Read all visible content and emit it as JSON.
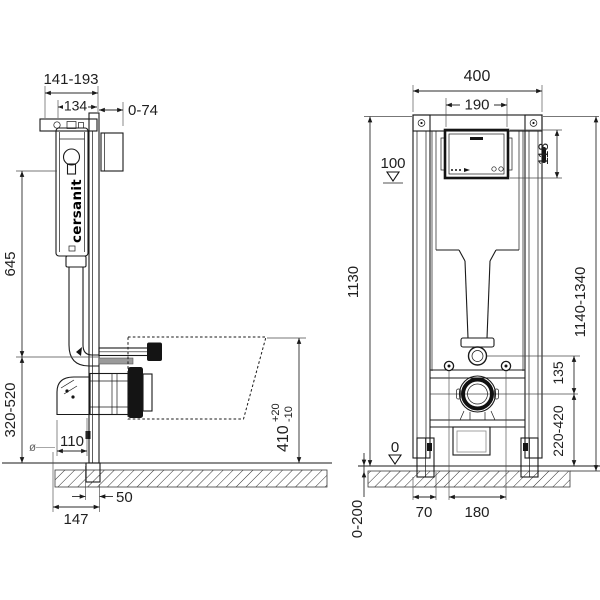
{
  "brand": {
    "logo": "cersanit"
  },
  "side_view": {
    "dims": {
      "depth_range": "141-193",
      "bracket_depth": "134",
      "wall_gap": "0-74",
      "cistern_height": "645",
      "outlet_height_range": "320-520",
      "bowl_height": "410",
      "bowl_height_plus": "+20",
      "bowl_height_minus": "-10",
      "drain_diameter_symbol": "ø",
      "drain_diameter": "110",
      "foot_depth": "50",
      "frame_depth": "147"
    }
  },
  "front_view": {
    "dims": {
      "frame_width": "400",
      "access_panel_width": "190",
      "access_panel_height": "118",
      "level_mark_top": "100",
      "frame_height": "1130",
      "overall_height_range": "1140-1340",
      "flush_outlet_offset": "135",
      "drain_height_range": "220-420",
      "level_mark_zero": "0",
      "foot_width": "70",
      "bolt_spacing": "180",
      "leg_adjustment_range": "0-200"
    }
  }
}
